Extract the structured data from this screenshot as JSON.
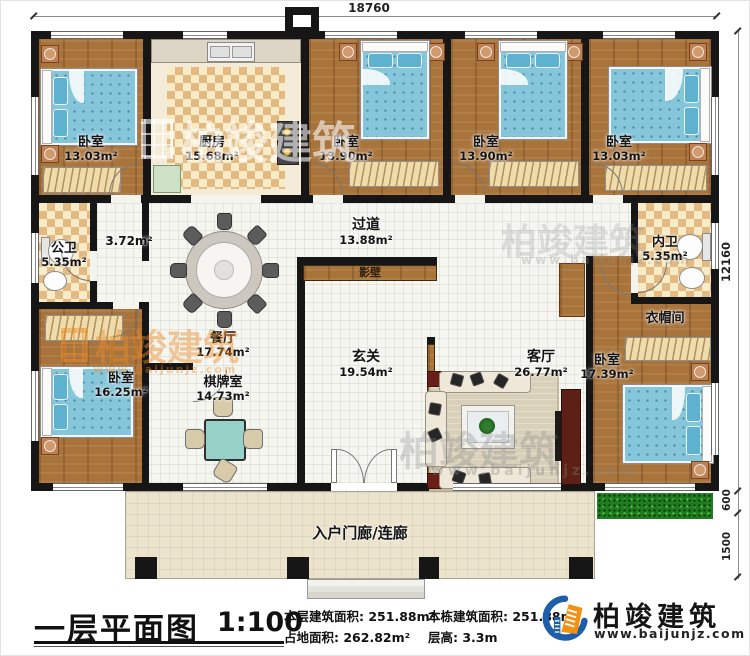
{
  "dimensions": {
    "width_top": "18760",
    "height_right": "12160",
    "grass_depth": "600",
    "porch_depth": "1500"
  },
  "rooms": {
    "bedroom_tl": {
      "name": "卧室",
      "area": "13.03m²"
    },
    "kitchen": {
      "name": "厨房",
      "area": "15.68m²"
    },
    "bedroom_t2": {
      "name": "卧室",
      "area": "13.90m²"
    },
    "bedroom_t3": {
      "name": "卧室",
      "area": "13.90m²"
    },
    "bedroom_tr": {
      "name": "卧室",
      "area": "13.03m²"
    },
    "public_bath": {
      "name": "公卫",
      "area": "5.35m²"
    },
    "hall": {
      "area": "3.72m²"
    },
    "corridor": {
      "name": "过道",
      "area": "13.88m²"
    },
    "screen_wall": {
      "name": "影壁"
    },
    "dining": {
      "name": "餐厅",
      "area": "17.74m²"
    },
    "inner_bath": {
      "name": "内卫",
      "area": "5.35m²"
    },
    "cloakroom": {
      "name": "衣帽间"
    },
    "bedroom_left": {
      "name": "卧室",
      "area": "16.25m²"
    },
    "chess_room": {
      "name": "棋牌室",
      "area": "14.73m²"
    },
    "foyer": {
      "name": "玄关",
      "area": "19.54m²"
    },
    "living": {
      "name": "客厅",
      "area": "26.77m²"
    },
    "bedroom_right": {
      "name": "卧室",
      "area": "17.39m²"
    },
    "porch": {
      "name": "入户门廊/连廊"
    }
  },
  "footer": {
    "title": "一层平面图",
    "scale": "1:100",
    "stats": [
      {
        "label": "本层建筑面积:",
        "value": "251.88m²"
      },
      {
        "label": "占地面积:",
        "value": "262.82m²"
      },
      {
        "label": "本栋建筑面积:",
        "value": "251.88m²"
      },
      {
        "label": "层高:",
        "value": "3.3m"
      }
    ],
    "brand": {
      "name": "柏竣建筑",
      "url": "www.baijunjz.com"
    }
  },
  "watermark": {
    "text": "柏竣建筑",
    "url": "www.baijunjz.com"
  }
}
